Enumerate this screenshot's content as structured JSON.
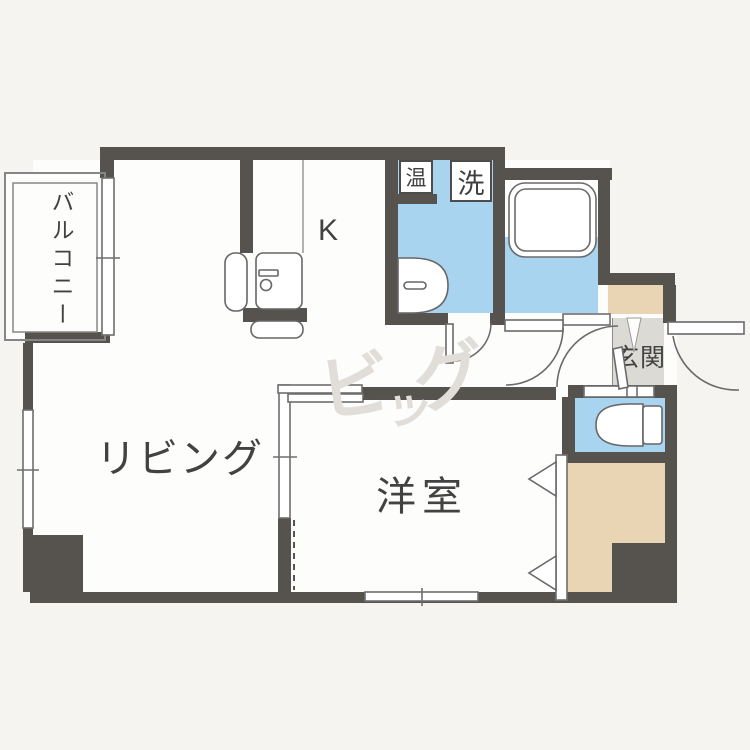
{
  "plan": {
    "rooms": {
      "balcony": "バルコニー",
      "living": "リビング",
      "kitchen": "K",
      "western_room": "洋室",
      "entrance": "玄関"
    },
    "fixtures": {
      "water_heater": "温",
      "washing_machine": "洗"
    },
    "watermark": {
      "char1": "ビ",
      "char2": "ッ",
      "char3": "グ"
    },
    "colors": {
      "wall": "#56534e",
      "water_rooms": "#a8d4ef",
      "closet": "#e9d4b3",
      "entrance_floor": "#dcdad5",
      "background": "#f5f4f0"
    }
  }
}
